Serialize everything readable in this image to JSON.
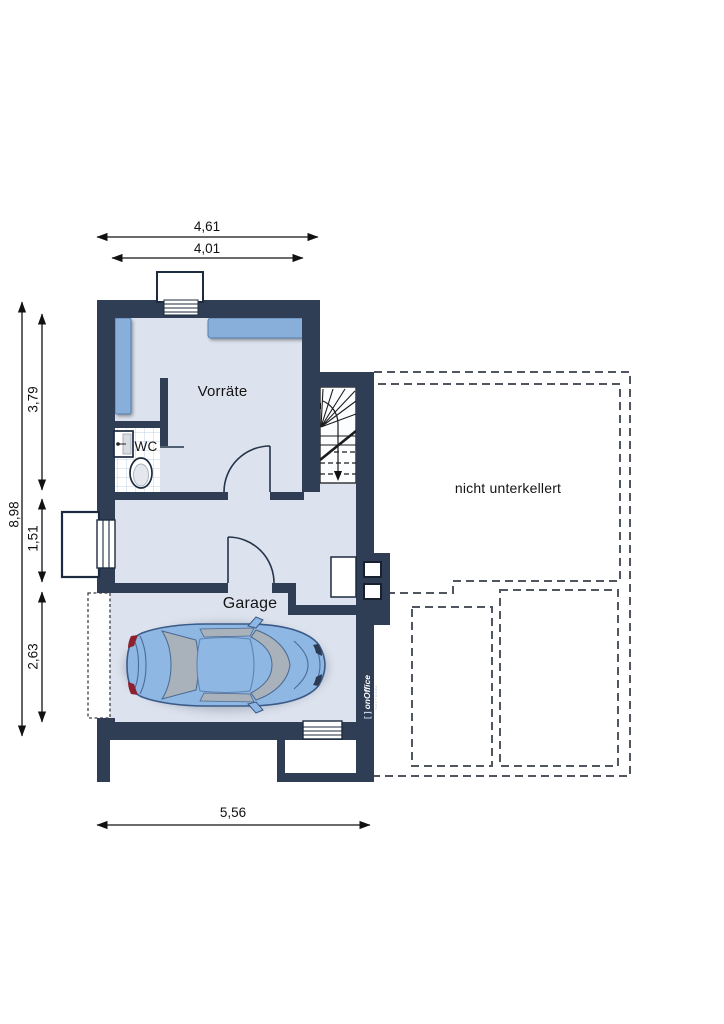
{
  "plan": {
    "rooms": {
      "storage": "Vorräte",
      "wc": "WC",
      "garage": "Garage"
    },
    "annotation": "nicht unterkellert",
    "dimensions": {
      "top_outer": "4,61",
      "top_inner": "4,01",
      "left_total": "8,98",
      "left_upper": "3,79",
      "left_middle": "1,51",
      "left_lower": "2,63",
      "bottom": "5,56"
    },
    "watermark": {
      "bracket": "[ ]",
      "brand": "onOffice",
      "tagline": "SOFTWARE"
    },
    "colors": {
      "wall": "#2f3e55",
      "floor": "#dde3ee",
      "stair_floor": "#fbfdff",
      "furniture": "#88afd9",
      "tile_line": "#c3d5e6",
      "car_body": "#8fb7e3",
      "car_glass": "#a9b1ba",
      "dash": "#50565f",
      "dimension": "#111111"
    }
  }
}
